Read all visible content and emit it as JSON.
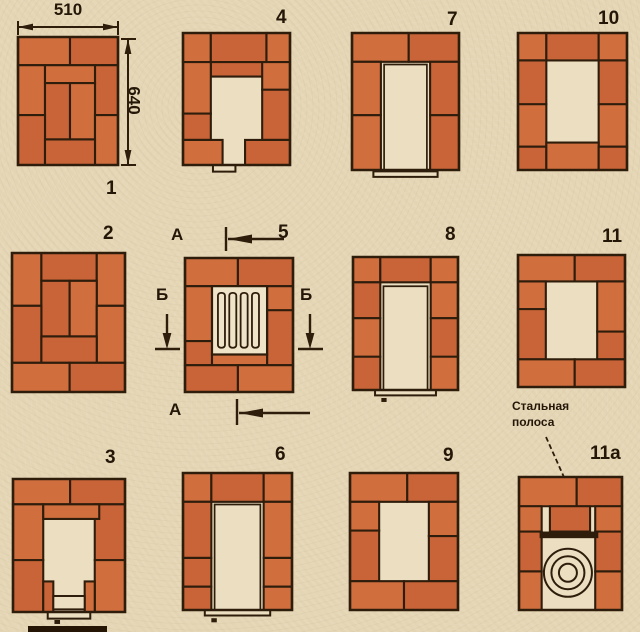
{
  "canvas": {
    "w": 640,
    "h": 632,
    "paper_color": "#e6d7b6",
    "brick_color": "#d06e3e",
    "brick_color_alt": "#c96438",
    "line_color": "#2f1d0c",
    "opening_color": "#ecdfc1",
    "text_color": "#241708"
  },
  "dimensions": {
    "width_label": "510",
    "height_label": "640"
  },
  "section_markers": {
    "a_top": "А",
    "a_bottom": "А",
    "b_left": "Б",
    "b_right": "Б"
  },
  "steel_strip_label": "Стальная полоса",
  "courses": [
    {
      "id": "1",
      "num": "1",
      "num_pos": {
        "x": 106,
        "y": 179
      },
      "frame": {
        "x": 18,
        "y": 37,
        "w": 100,
        "h": 128
      },
      "bricks": [
        [
          0,
          0,
          52,
          22
        ],
        [
          52,
          0,
          48,
          22
        ],
        [
          0,
          22,
          27,
          39
        ],
        [
          77,
          22,
          23,
          39
        ],
        [
          27,
          22,
          50,
          14
        ],
        [
          27,
          36,
          25,
          44
        ],
        [
          52,
          36,
          25,
          44
        ],
        [
          0,
          61,
          27,
          39
        ],
        [
          77,
          61,
          23,
          39
        ],
        [
          27,
          80,
          50,
          20
        ]
      ]
    },
    {
      "id": "2",
      "num": "2",
      "num_pos": {
        "x": 103,
        "y": 224
      },
      "frame": {
        "x": 12,
        "y": 253,
        "w": 113,
        "h": 139
      },
      "bricks": [
        [
          0,
          0,
          26,
          38
        ],
        [
          26,
          0,
          49,
          20
        ],
        [
          75,
          0,
          25,
          38
        ],
        [
          26,
          20,
          25,
          40
        ],
        [
          51,
          20,
          24,
          40
        ],
        [
          0,
          38,
          26,
          41
        ],
        [
          75,
          38,
          25,
          41
        ],
        [
          26,
          60,
          49,
          19
        ],
        [
          0,
          79,
          51,
          21
        ],
        [
          51,
          79,
          49,
          21
        ]
      ]
    },
    {
      "id": "3",
      "num": "3",
      "num_pos": {
        "x": 105,
        "y": 448
      },
      "frame": {
        "x": 13,
        "y": 479,
        "w": 112,
        "h": 133
      },
      "bricks": [
        [
          0,
          0,
          51,
          19
        ],
        [
          51,
          0,
          49,
          19
        ],
        [
          0,
          19,
          27,
          42
        ],
        [
          73,
          19,
          27,
          42
        ],
        [
          27,
          19,
          50,
          11
        ],
        [
          0,
          61,
          27,
          39
        ],
        [
          73,
          61,
          27,
          39
        ],
        [
          27,
          77,
          9,
          23
        ],
        [
          64,
          77,
          9,
          23
        ]
      ],
      "light_rects": [
        [
          36,
          88,
          28,
          10
        ],
        [
          31,
          100,
          38,
          5
        ]
      ],
      "dark_rects": [
        [
          37,
          106,
          5,
          3
        ]
      ]
    },
    {
      "id": "4",
      "num": "4",
      "num_pos": {
        "x": 276,
        "y": 8
      },
      "frame": {
        "x": 183,
        "y": 33,
        "w": 107,
        "h": 132
      },
      "bricks": [
        [
          0,
          0,
          26,
          22
        ],
        [
          26,
          0,
          52,
          22
        ],
        [
          78,
          0,
          22,
          22
        ],
        [
          26,
          22,
          52,
          11
        ],
        [
          0,
          22,
          26,
          39
        ],
        [
          0,
          61,
          26,
          20
        ],
        [
          74,
          22,
          26,
          21
        ],
        [
          74,
          43,
          26,
          38
        ],
        [
          0,
          81,
          37,
          19
        ],
        [
          58,
          81,
          42,
          19
        ]
      ],
      "light_rects": [
        [
          28,
          100,
          21,
          5
        ]
      ]
    },
    {
      "id": "5",
      "num": "5",
      "num_pos": {
        "x": 278,
        "y": 223
      },
      "frame": {
        "x": 185,
        "y": 258,
        "w": 108,
        "h": 134
      },
      "bricks": [
        [
          0,
          0,
          49,
          21
        ],
        [
          49,
          0,
          51,
          21
        ],
        [
          0,
          21,
          25,
          41
        ],
        [
          0,
          62,
          25,
          18
        ],
        [
          76,
          21,
          24,
          18
        ],
        [
          76,
          39,
          24,
          41
        ],
        [
          25,
          72,
          51,
          8
        ],
        [
          0,
          80,
          49,
          20
        ],
        [
          49,
          80,
          51,
          20
        ]
      ],
      "grate": {
        "box": [
          25,
          21,
          51,
          51
        ],
        "bars": [
          [
            30.5,
            26,
            6.5,
            41
          ],
          [
            41,
            26,
            6.5,
            41
          ],
          [
            51.5,
            26,
            6.5,
            41
          ],
          [
            62,
            26,
            6.5,
            41
          ]
        ]
      }
    },
    {
      "id": "6",
      "num": "6",
      "num_pos": {
        "x": 275,
        "y": 445
      },
      "frame": {
        "x": 183,
        "y": 473,
        "w": 109,
        "h": 137
      },
      "bricks": [
        [
          0,
          0,
          26,
          21
        ],
        [
          26,
          0,
          48,
          21
        ],
        [
          74,
          0,
          26,
          21
        ],
        [
          0,
          21,
          26,
          41
        ],
        [
          74,
          21,
          26,
          41
        ],
        [
          0,
          62,
          26,
          21
        ],
        [
          74,
          62,
          26,
          21
        ],
        [
          0,
          83,
          26,
          17
        ],
        [
          74,
          83,
          26,
          17
        ]
      ],
      "outline_rects": [
        [
          29,
          23,
          42,
          77
        ]
      ],
      "light_rects": [
        [
          20,
          100,
          60,
          4
        ]
      ],
      "dark_rects": [
        [
          26,
          106,
          5,
          3
        ]
      ]
    },
    {
      "id": "7",
      "num": "7",
      "num_pos": {
        "x": 447,
        "y": 10
      },
      "frame": {
        "x": 352,
        "y": 33,
        "w": 107,
        "h": 137
      },
      "bricks": [
        [
          0,
          0,
          53,
          21
        ],
        [
          53,
          0,
          47,
          21
        ],
        [
          0,
          21,
          27,
          39
        ],
        [
          73,
          21,
          27,
          39
        ],
        [
          0,
          60,
          27,
          40
        ],
        [
          73,
          60,
          27,
          40
        ]
      ],
      "outline_rects": [
        [
          30,
          23,
          40,
          77
        ]
      ],
      "light_rects": [
        [
          20,
          101,
          60,
          4
        ]
      ]
    },
    {
      "id": "8",
      "num": "8",
      "num_pos": {
        "x": 445,
        "y": 225
      },
      "frame": {
        "x": 353,
        "y": 257,
        "w": 105,
        "h": 133
      },
      "bricks": [
        [
          0,
          0,
          26,
          19
        ],
        [
          26,
          0,
          48,
          19
        ],
        [
          74,
          0,
          26,
          19
        ],
        [
          0,
          19,
          26,
          27
        ],
        [
          0,
          46,
          26,
          29
        ],
        [
          0,
          75,
          26,
          25
        ],
        [
          74,
          19,
          26,
          27
        ],
        [
          74,
          46,
          26,
          29
        ],
        [
          74,
          75,
          26,
          25
        ]
      ],
      "outline_rects": [
        [
          29,
          22,
          42,
          78
        ]
      ],
      "light_rects": [
        [
          21,
          100,
          58,
          4
        ]
      ],
      "dark_rects": [
        [
          27,
          106,
          5,
          3
        ]
      ]
    },
    {
      "id": "9",
      "num": "9",
      "num_pos": {
        "x": 443,
        "y": 446
      },
      "frame": {
        "x": 350,
        "y": 473,
        "w": 108,
        "h": 137
      },
      "bricks": [
        [
          0,
          0,
          53,
          21
        ],
        [
          53,
          0,
          47,
          21
        ],
        [
          0,
          21,
          27,
          21
        ],
        [
          0,
          42,
          27,
          37
        ],
        [
          73,
          21,
          27,
          25
        ],
        [
          73,
          46,
          27,
          33
        ],
        [
          0,
          79,
          50,
          21
        ],
        [
          50,
          79,
          50,
          21
        ]
      ]
    },
    {
      "id": "10",
      "num": "10",
      "num_pos": {
        "x": 598,
        "y": 9
      },
      "frame": {
        "x": 518,
        "y": 33,
        "w": 109,
        "h": 137
      },
      "bricks": [
        [
          0,
          0,
          26,
          20
        ],
        [
          26,
          0,
          48,
          20
        ],
        [
          74,
          0,
          26,
          20
        ],
        [
          0,
          20,
          26,
          32
        ],
        [
          0,
          52,
          26,
          31
        ],
        [
          74,
          20,
          26,
          32
        ],
        [
          74,
          52,
          26,
          31
        ],
        [
          0,
          83,
          26,
          17
        ],
        [
          26,
          80,
          48,
          20
        ],
        [
          74,
          83,
          26,
          17
        ]
      ]
    },
    {
      "id": "11",
      "num": "11",
      "num_pos": {
        "x": 602,
        "y": 227
      },
      "frame": {
        "x": 518,
        "y": 255,
        "w": 107,
        "h": 132
      },
      "bricks": [
        [
          0,
          0,
          53,
          20
        ],
        [
          53,
          0,
          47,
          20
        ],
        [
          0,
          20,
          26,
          21
        ],
        [
          0,
          41,
          26,
          38
        ],
        [
          74,
          20,
          26,
          38
        ],
        [
          74,
          58,
          26,
          21
        ],
        [
          0,
          79,
          53,
          21
        ],
        [
          53,
          79,
          47,
          21
        ]
      ]
    },
    {
      "id": "11a",
      "num": "11а",
      "num_pos": {
        "x": 590,
        "y": 444
      },
      "frame": {
        "x": 519,
        "y": 477,
        "w": 103,
        "h": 133
      },
      "bricks": [
        [
          0,
          0,
          56,
          22
        ],
        [
          56,
          0,
          44,
          22
        ],
        [
          0,
          22,
          22,
          19
        ],
        [
          30,
          22,
          39,
          19
        ],
        [
          74,
          22,
          26,
          19
        ],
        [
          0,
          41,
          22,
          30
        ],
        [
          0,
          71,
          22,
          29
        ],
        [
          74,
          41,
          26,
          30
        ],
        [
          74,
          71,
          26,
          29
        ]
      ],
      "dark_rects": [
        [
          20,
          41,
          57,
          5
        ]
      ],
      "circles": [
        {
          "cx": 47.5,
          "cy": 72,
          "r_px": 24
        },
        {
          "cx": 47.5,
          "cy": 72,
          "r_px": 16.5
        },
        {
          "cx": 47.5,
          "cy": 72,
          "r_px": 9
        }
      ]
    }
  ]
}
